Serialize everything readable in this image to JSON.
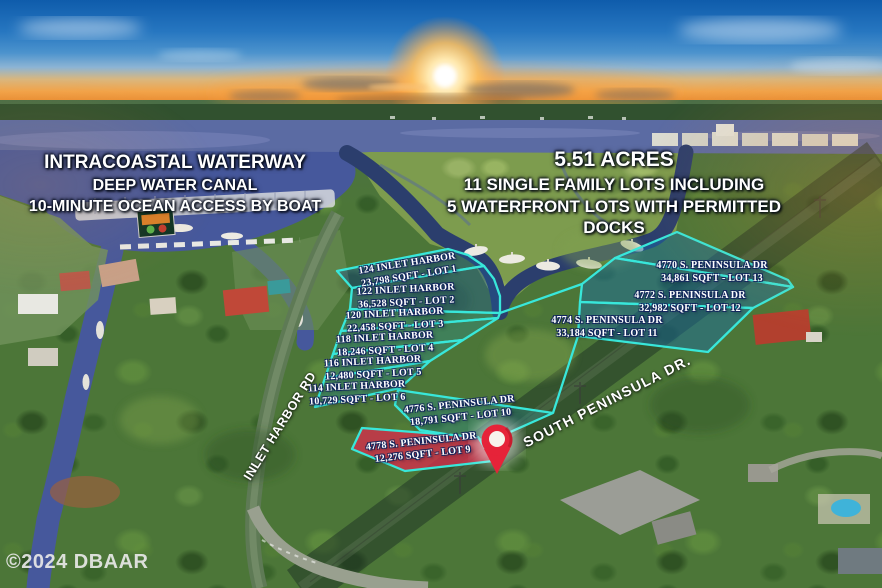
{
  "headline_left": {
    "line1": "INTRACOASTAL WATERWAY",
    "line2": "DEEP WATER CANAL",
    "line3": "10-MINUTE OCEAN ACCESS BY BOAT"
  },
  "headline_right": {
    "line1": "5.51 ACRES",
    "line2": "11 SINGLE FAMILY LOTS INCLUDING",
    "line3": "5 WATERFRONT LOTS WITH PERMITTED DOCKS"
  },
  "streets": {
    "inlet_harbor_rd": "INLET HARBOR RD",
    "south_peninsula_dr": "SOUTH PENINSULA DR."
  },
  "lots": [
    {
      "address": "124 INLET HARBOR",
      "size": "23,798 SQFT - LOT 1"
    },
    {
      "address": "122 INLET HARBOR",
      "size": "36,528 SQFT - LOT 2"
    },
    {
      "address": "120 INLET HARBOR",
      "size": "22,458 SQFT - LOT 3"
    },
    {
      "address": "118 INLET HARBOR",
      "size": "18,246 SQFT - LOT 4"
    },
    {
      "address": "116 INLET HARBOR",
      "size": "12,480 SQFT - LOT 5"
    },
    {
      "address": "114 INLET HARBOR",
      "size": "10,729 SQFT - LOT 6"
    },
    {
      "address": "4776 S. PENINSULA DR",
      "size": "18,791 SQFT - LOT 10"
    },
    {
      "address": "4778 S. PENINSULA DR",
      "size": "12,276 SQFT - LOT 9"
    },
    {
      "address": "4770 S. PENINSULA DR",
      "size": "34,861 SQFT - LOT 13"
    },
    {
      "address": "4772 S. PENINSULA DR",
      "size": "32,982 SQFT - LOT 12"
    },
    {
      "address": "4774 S. PENINSULA DR",
      "size": "33,184 SQFT - LOT 11"
    }
  ],
  "watermark": "©2024 DBAAR",
  "colors": {
    "lot_outline": "#38e7da",
    "lot_fill_land": "rgba(40,150,160,0.32)",
    "lot_fill_waterfront": "rgba(30,90,150,0.42)",
    "highlighted_lot_fill": "rgba(215,45,75,0.78)",
    "pin_red": "#e62339",
    "river_water": "#5b6ba3",
    "canal_water": "#46589c"
  }
}
